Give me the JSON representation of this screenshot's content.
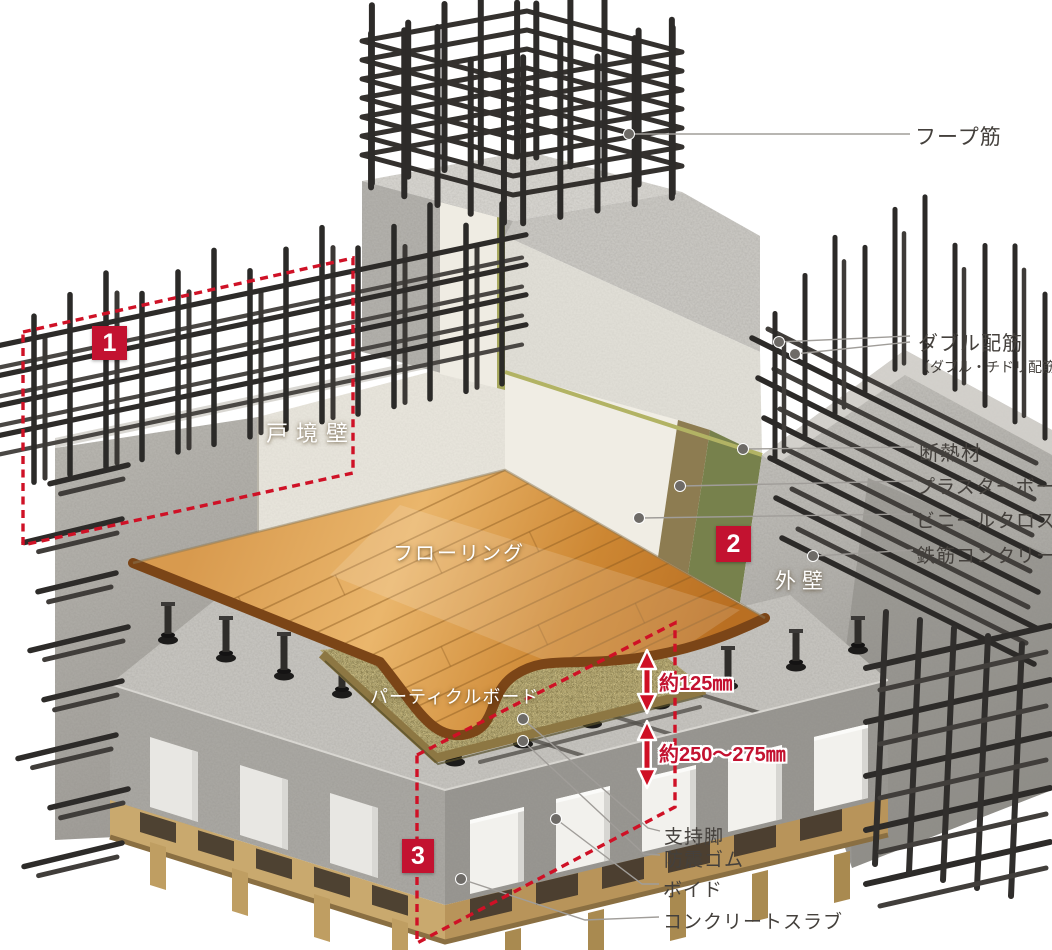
{
  "colors": {
    "accent_red": "#c31230",
    "label_text": "#44403c",
    "white_label": "#ffffff",
    "leader_line": "#a09d99"
  },
  "markers": [
    {
      "num": "1"
    },
    {
      "num": "2"
    },
    {
      "num": "3"
    }
  ],
  "callouts_right": [
    {
      "label": "フープ筋"
    },
    {
      "label": "ダブル配筋",
      "sublabel": "（ダブル・チドリ配筋）"
    },
    {
      "label": "断熱材"
    },
    {
      "label": "プラスターボード"
    },
    {
      "label": "ビニールクロス"
    },
    {
      "label": "鉄筋コンクリート"
    }
  ],
  "callouts_bottom": [
    {
      "label": "支持脚"
    },
    {
      "label": "防震ゴム"
    },
    {
      "label": "ボイド"
    },
    {
      "label": "コンクリートスラブ"
    }
  ],
  "scene_labels": [
    {
      "label": "戸境壁"
    },
    {
      "label": "フローリング"
    },
    {
      "label": "パーティクルボード"
    },
    {
      "label": "外壁"
    }
  ],
  "dimensions": [
    {
      "label": "約125㎜"
    },
    {
      "label": "約250〜275㎜"
    }
  ]
}
